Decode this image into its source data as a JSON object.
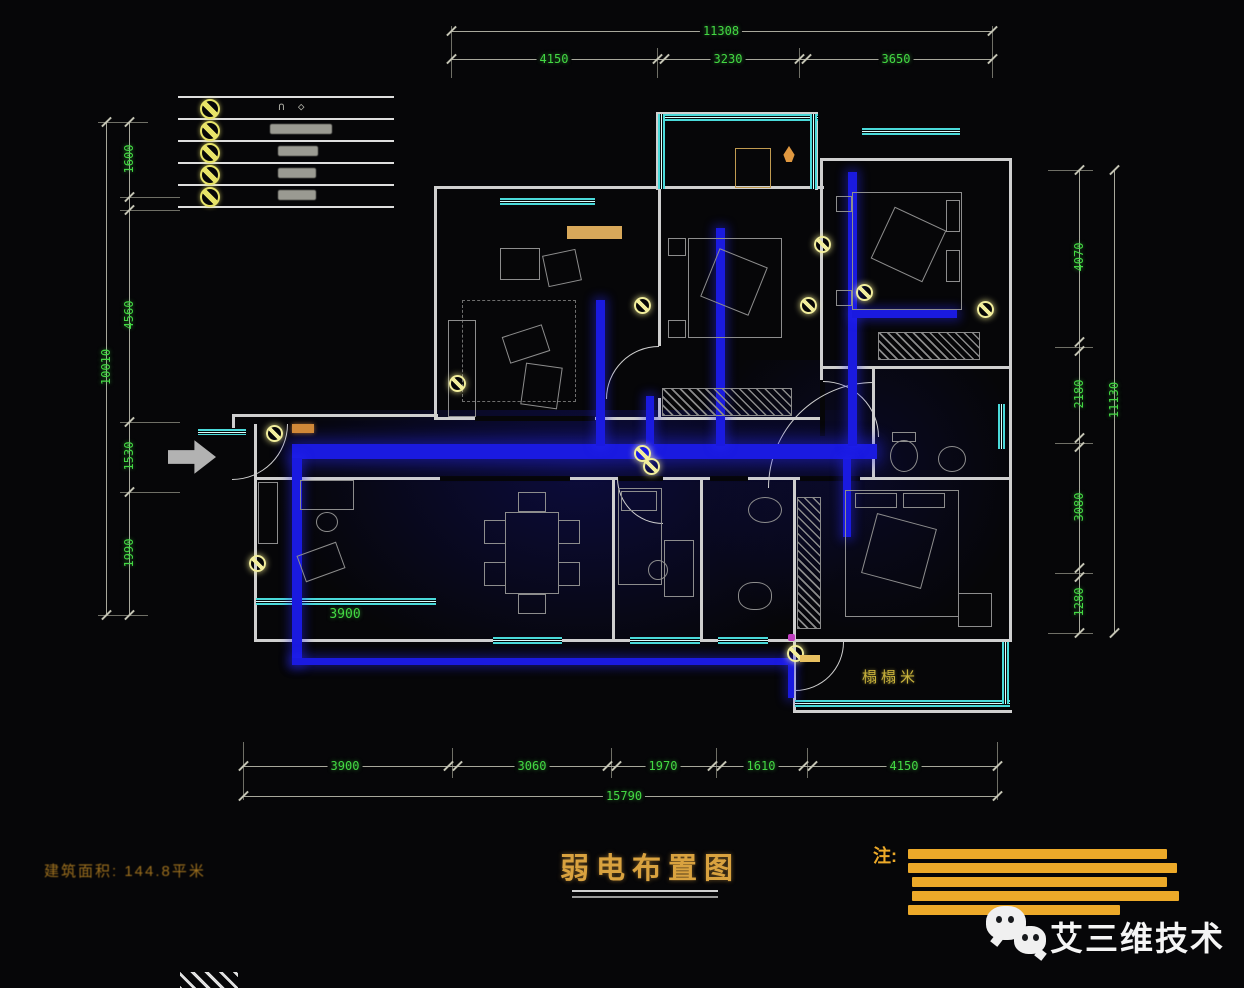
{
  "legend": {
    "rows": [
      {
        "icon": "weak-current-symbol-1-icon"
      },
      {
        "icon": "weak-current-symbol-2-icon"
      },
      {
        "icon": "weak-current-symbol-3-icon"
      },
      {
        "icon": "weak-current-symbol-4-icon"
      },
      {
        "icon": "weak-current-symbol-5-icon"
      }
    ]
  },
  "dimensions": {
    "top": {
      "overall": "11308",
      "segments": [
        "4150",
        "3230",
        "3650"
      ]
    },
    "left": {
      "overall": "10010",
      "segments": [
        "1600",
        "4560",
        "1530",
        "1990"
      ]
    },
    "right": {
      "overall": "11130",
      "segments": [
        "4070",
        "2180",
        "3080",
        "1280"
      ]
    },
    "bottom": {
      "overall": "15790",
      "segments": [
        "3900",
        "3060",
        "1970",
        "1610",
        "4150"
      ]
    },
    "interior": {
      "dining": "3900"
    }
  },
  "plan": {
    "tatami_label": "榻榻米"
  },
  "title": {
    "text": "弱电布置图"
  },
  "notes": {
    "label": "注:"
  },
  "footer": {
    "area_text": "建筑面积: 144.8平米"
  },
  "watermark": {
    "text": "艾三维技术",
    "icon": "wechat-icon"
  },
  "colors": {
    "dimension_green": "#43d843",
    "cable_blue": "#1a1ae0",
    "window_cyan": "#4adada",
    "title_orange": "#d9a23f",
    "note_bar_orange": "#eca929",
    "outlet_yellow": "#f2ee9c",
    "legend_yellow": "#e8e468"
  }
}
